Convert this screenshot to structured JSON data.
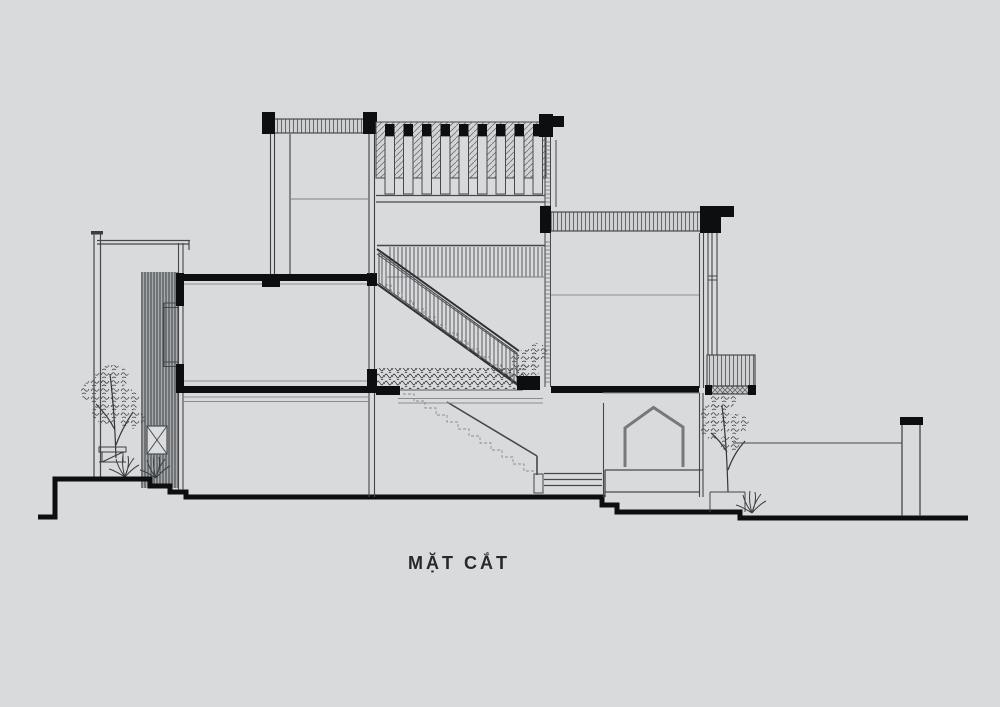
{
  "drawing": {
    "title": "MẶT CẮT",
    "type": "architectural-section-elevation"
  },
  "palette": {
    "background": "#d9dadb",
    "ink": "#44474b",
    "cut_black": "#0d0e0f",
    "hatch_gray": "#5a5e62",
    "screen_gray": "#8f959a"
  }
}
